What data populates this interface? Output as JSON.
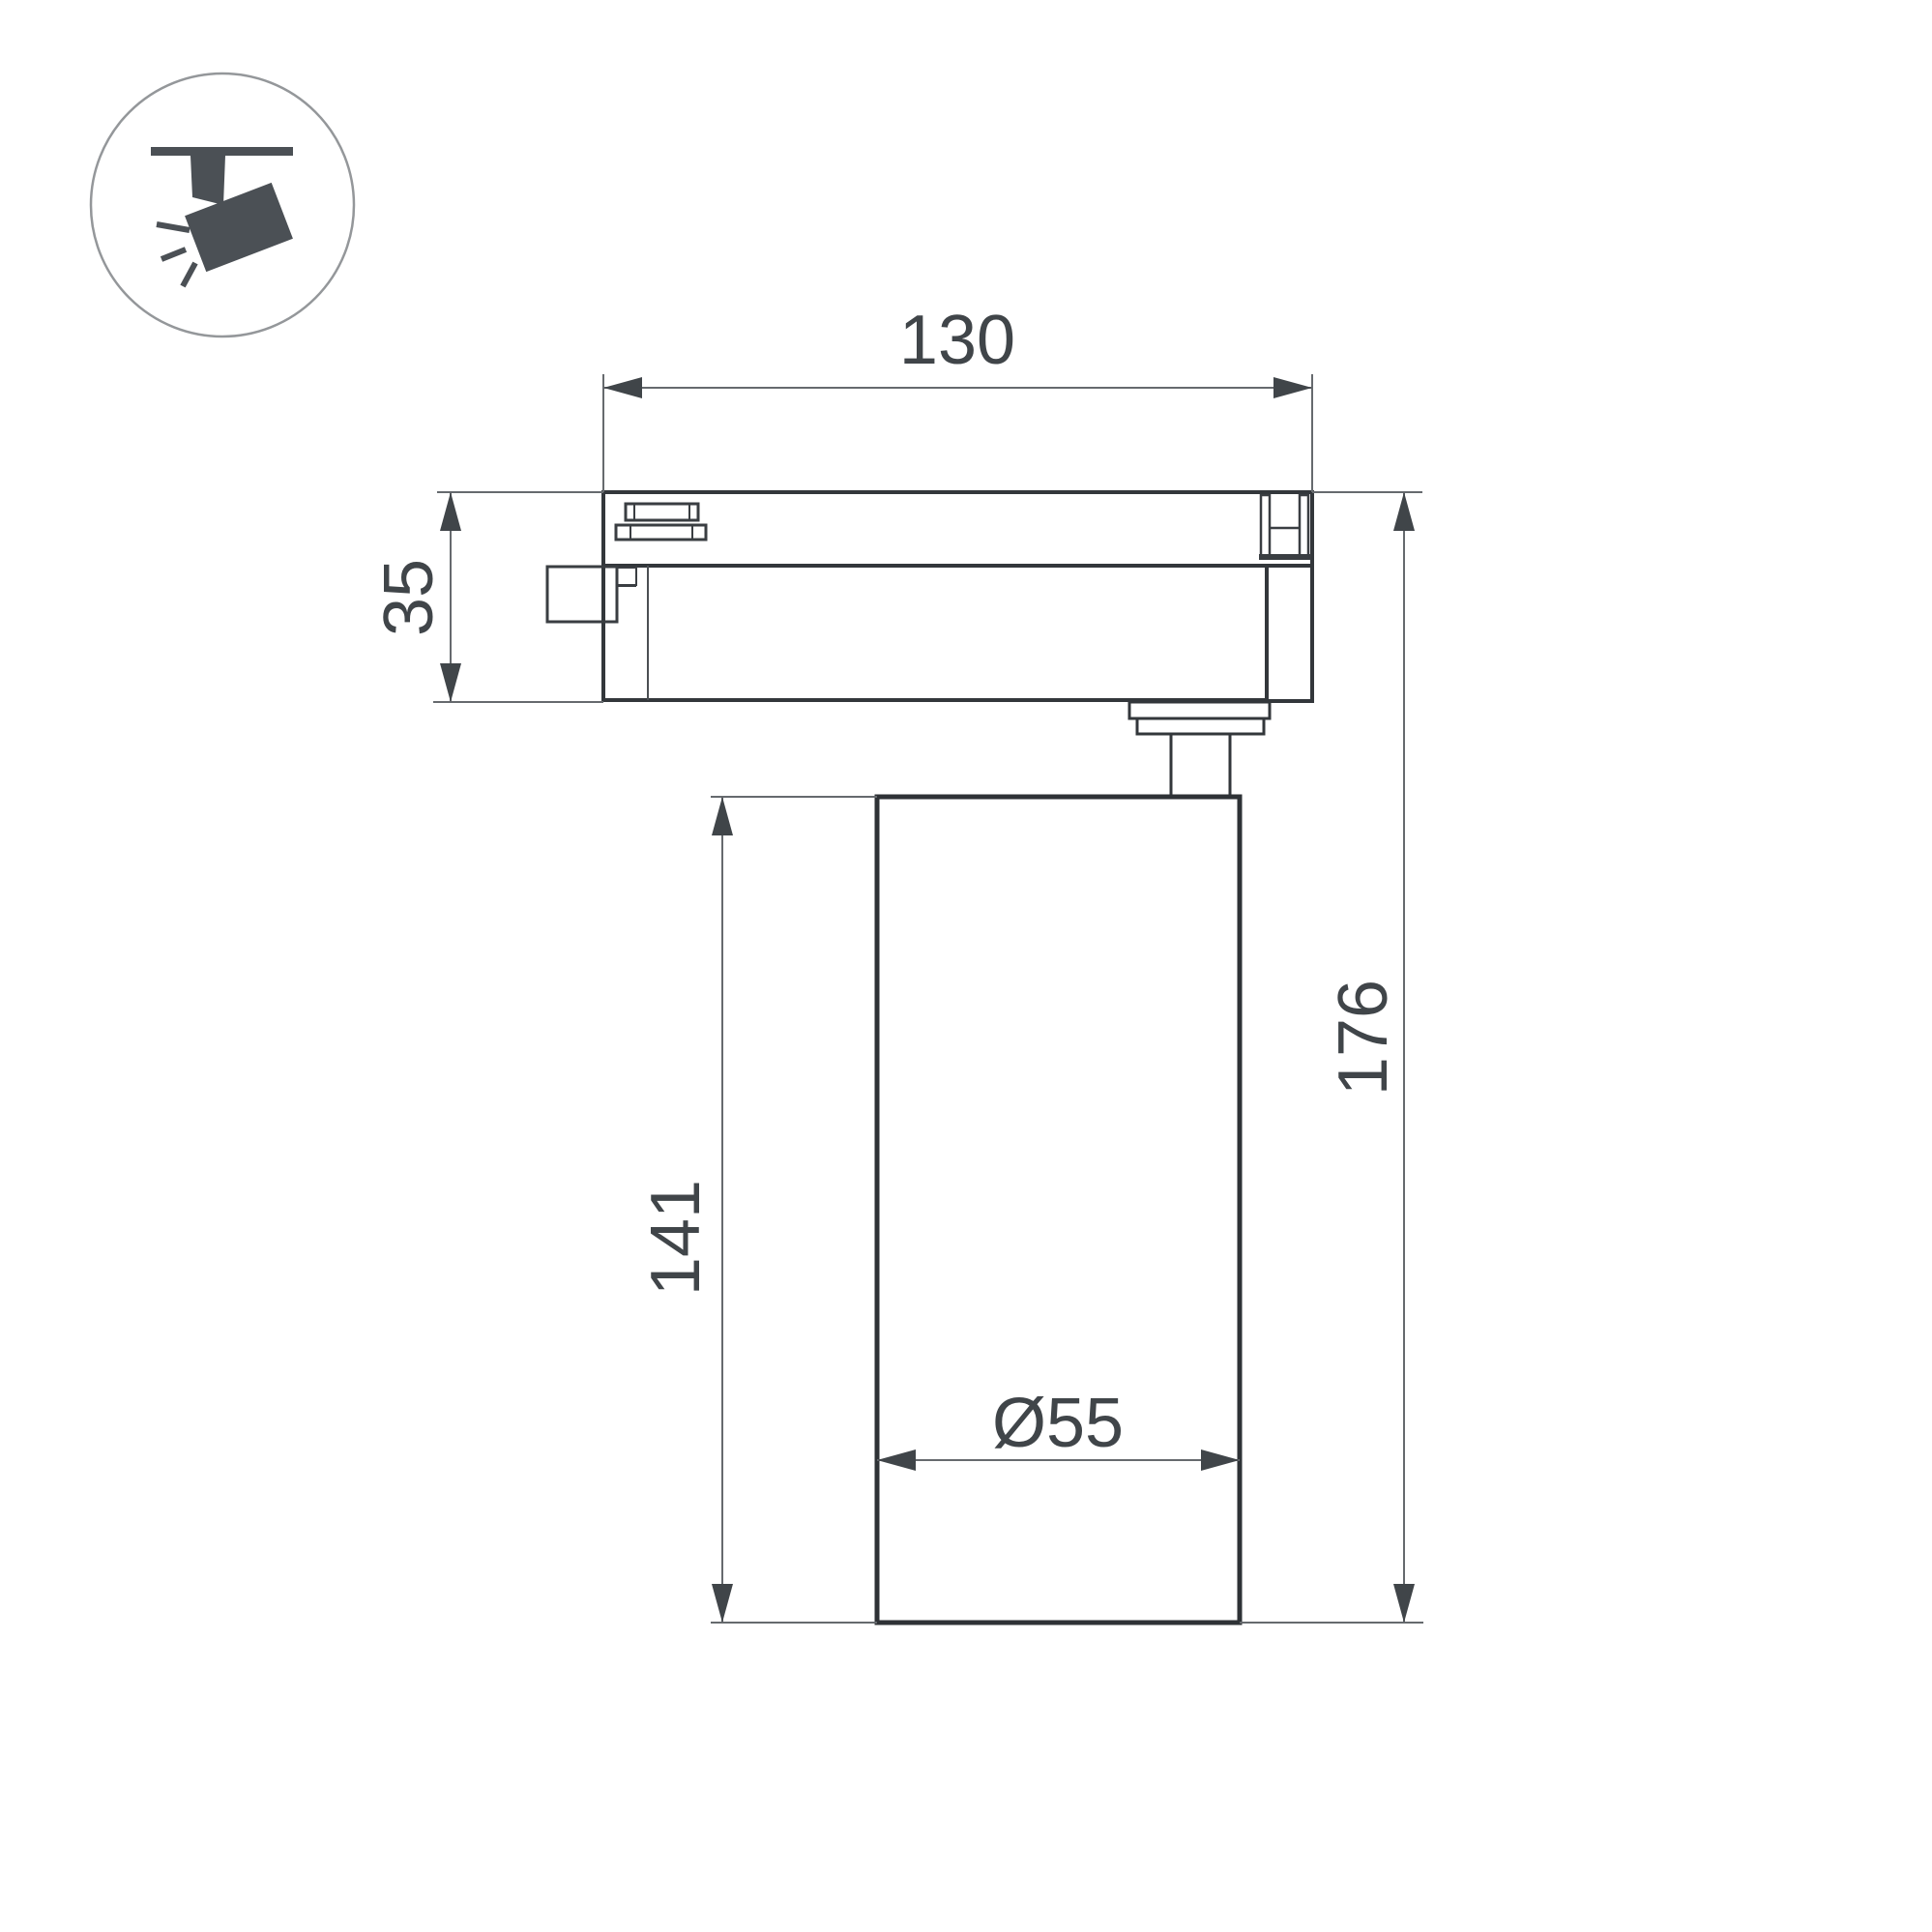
{
  "drawing": {
    "type": "technical-dimension-drawing",
    "subject": "track-mounted-spotlight",
    "dimensions": {
      "track_width": {
        "label": "130"
      },
      "adapter_height": {
        "label": "35"
      },
      "body_height": {
        "label": "141"
      },
      "overall_height": {
        "label": "176"
      },
      "body_diameter": {
        "label": "Ø55"
      }
    },
    "icon": {
      "name": "track-spotlight"
    },
    "colors": {
      "background": "#ffffff",
      "outline_dark": "#33373b",
      "outline_medium": "#4b4f53",
      "dimension_line": "#666a6e",
      "arrow_and_text": "#404549",
      "icon_fill": "#4b5055",
      "icon_circle_stroke": "#94979a"
    }
  }
}
